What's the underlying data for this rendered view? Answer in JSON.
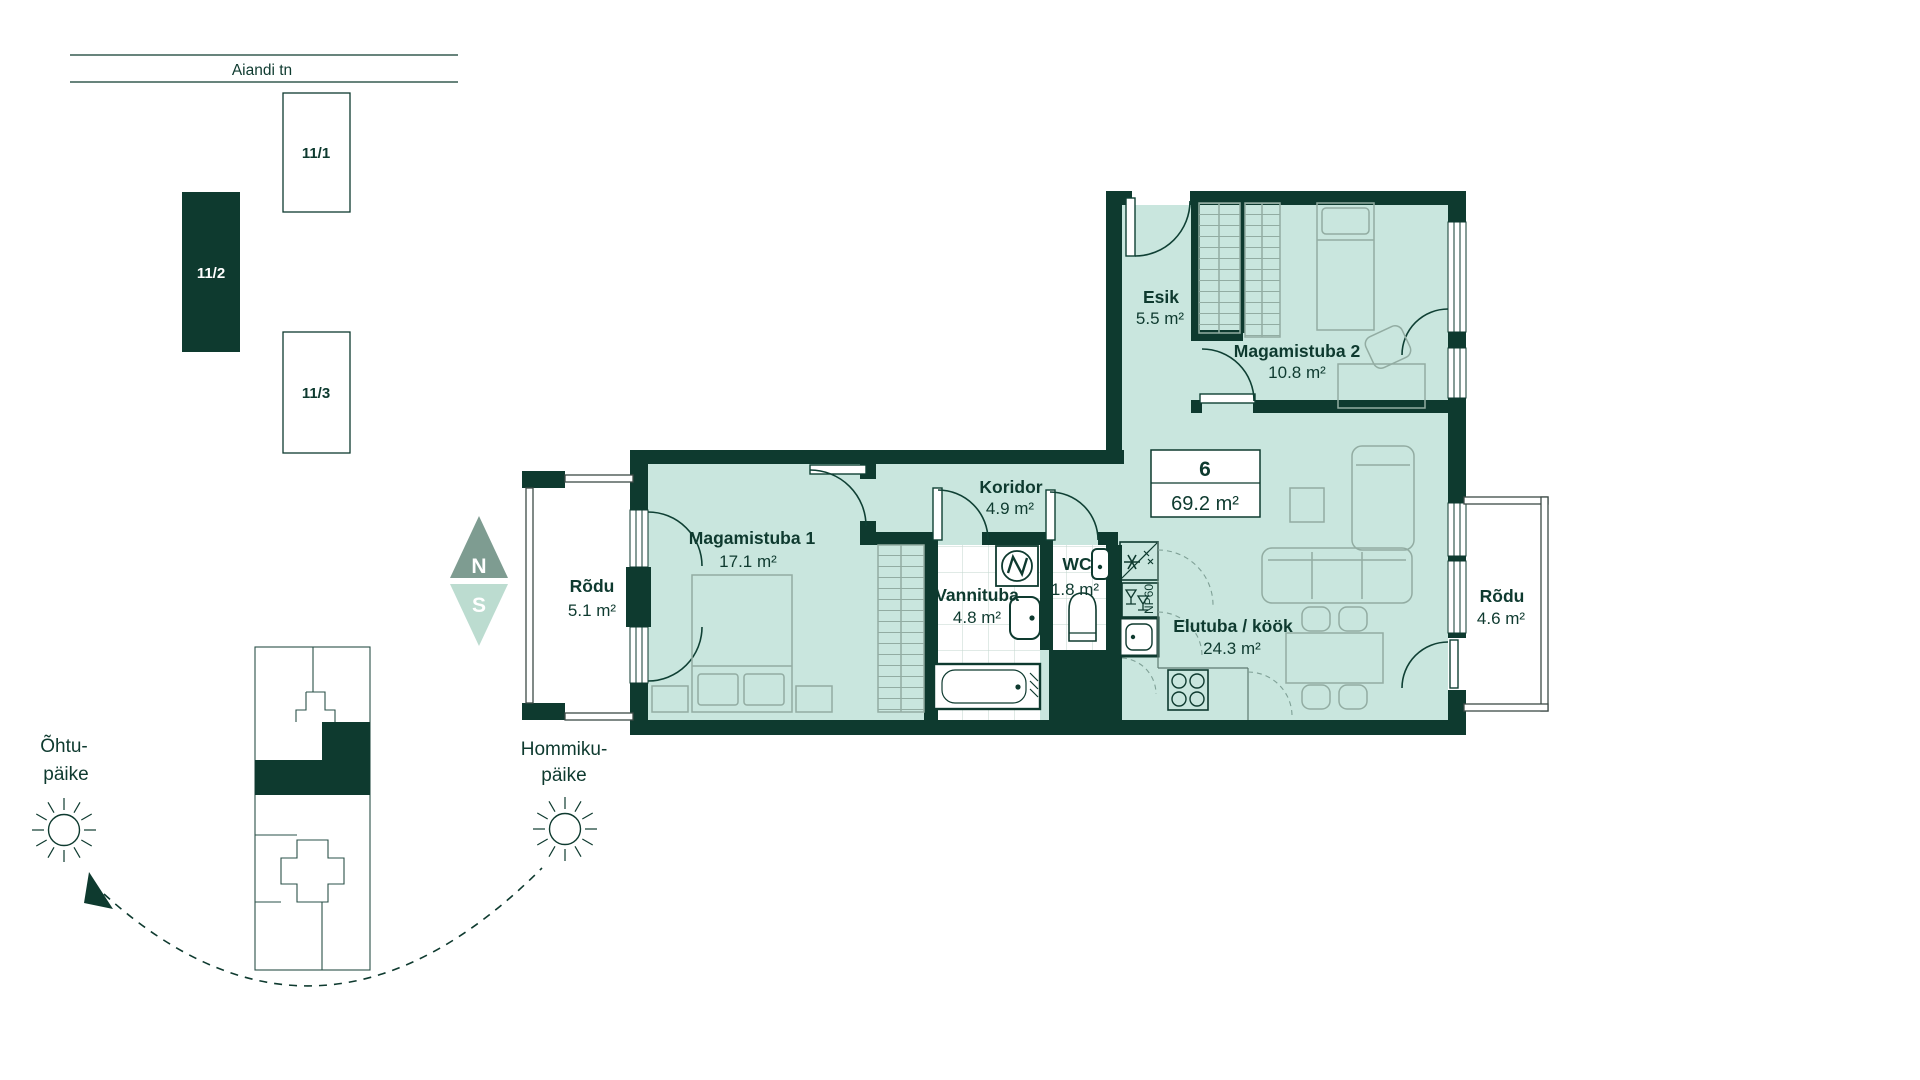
{
  "street": {
    "name": "Aiandi tn"
  },
  "site": {
    "buildings": [
      {
        "label": "11/1"
      },
      {
        "label": "11/2"
      },
      {
        "label": "11/3"
      }
    ]
  },
  "compass": {
    "n": "N",
    "s": "S"
  },
  "unit": {
    "number": "6",
    "area": "69.2 m²"
  },
  "rooms": {
    "balcony_left": {
      "name": "Rõdu",
      "area": "5.1 m²"
    },
    "bedroom1": {
      "name": "Magamistuba 1",
      "area": "17.1 m²"
    },
    "bathroom": {
      "name": "Vannituba",
      "area": "4.8 m²"
    },
    "wc": {
      "name": "WC",
      "area": "1.8 m²"
    },
    "corridor": {
      "name": "Koridor",
      "area": "4.9 m²"
    },
    "hall": {
      "name": "Esik",
      "area": "5.5 m²"
    },
    "bedroom2": {
      "name": "Magamistuba 2",
      "area": "10.8 m²"
    },
    "living": {
      "name": "Elutuba / köök",
      "area": "24.3 m²"
    },
    "balcony_right": {
      "name": "Rõdu",
      "area": "4.6 m²"
    }
  },
  "sun": {
    "evening_line1": "Õhtu-",
    "evening_line2": "päike",
    "morning_line1": "Hommiku-",
    "morning_line2": "päike"
  },
  "kitchen": {
    "dishwasher_label": "NP60"
  },
  "colors": {
    "wall": "#0E3A2F",
    "floor": "#C9E6DE",
    "furniture": "#92ACA2",
    "compass_north": "#7E9C91",
    "compass_south": "#BCDCD0",
    "tile_grid": "#C2D6CE"
  }
}
